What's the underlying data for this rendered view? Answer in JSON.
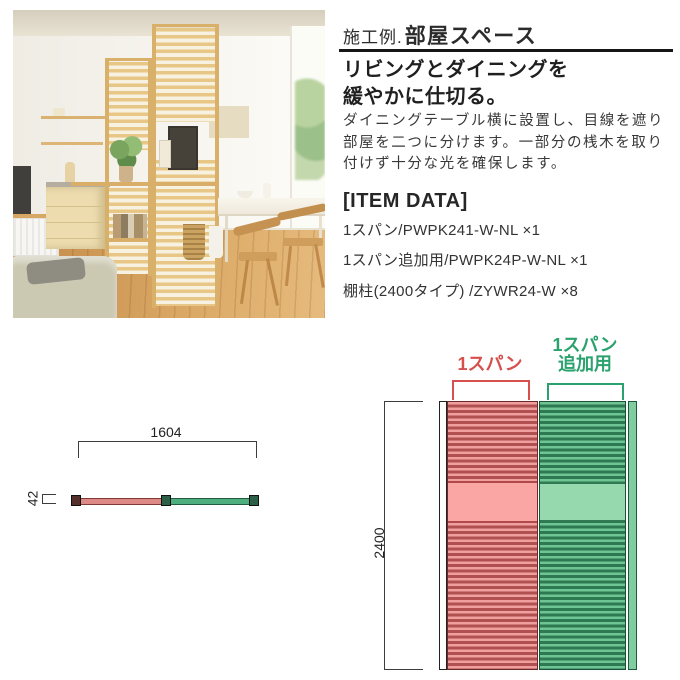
{
  "theme": {
    "red_label": "#d6504d",
    "red_slat_light": "#f09e9e",
    "red_slat_dark": "#b05050",
    "red_solid": "#f9a6a4",
    "red_outline": "#6b2a2a",
    "green_label": "#2ba26e",
    "green_slat_light": "#6fc493",
    "green_slat_dark": "#2d7a52",
    "green_solid": "#97d9ae",
    "green_outline": "#1c5138"
  },
  "header": {
    "title_prefix": "施工例.",
    "title_main": "部屋スペース"
  },
  "subtitle": {
    "line1": "リビングとダイニングを",
    "line2": "緩やかに仕切る。"
  },
  "description": {
    "line1": "ダイニングテーブル横に設置し、目線を遮り",
    "line2": "部屋を二つに分けます。一部分の桟木を取り",
    "line3": "付けず十分な光を確保します。"
  },
  "item_data": {
    "heading": "[ITEM DATA]",
    "items": [
      "1スパン/PWPK241-W-NL ×1",
      "1スパン追加用/PWPK24P-W-NL ×1",
      "棚柱(2400タイプ) /ZYWR24-W ×8"
    ]
  },
  "diagrams": {
    "top_view": {
      "width_dim": "1604",
      "depth_dim": "42"
    },
    "front_view": {
      "height_dim": "2400",
      "span1_label": "1スパン",
      "span2_label_line1": "1スパン",
      "span2_label_line2": "追加用"
    }
  }
}
